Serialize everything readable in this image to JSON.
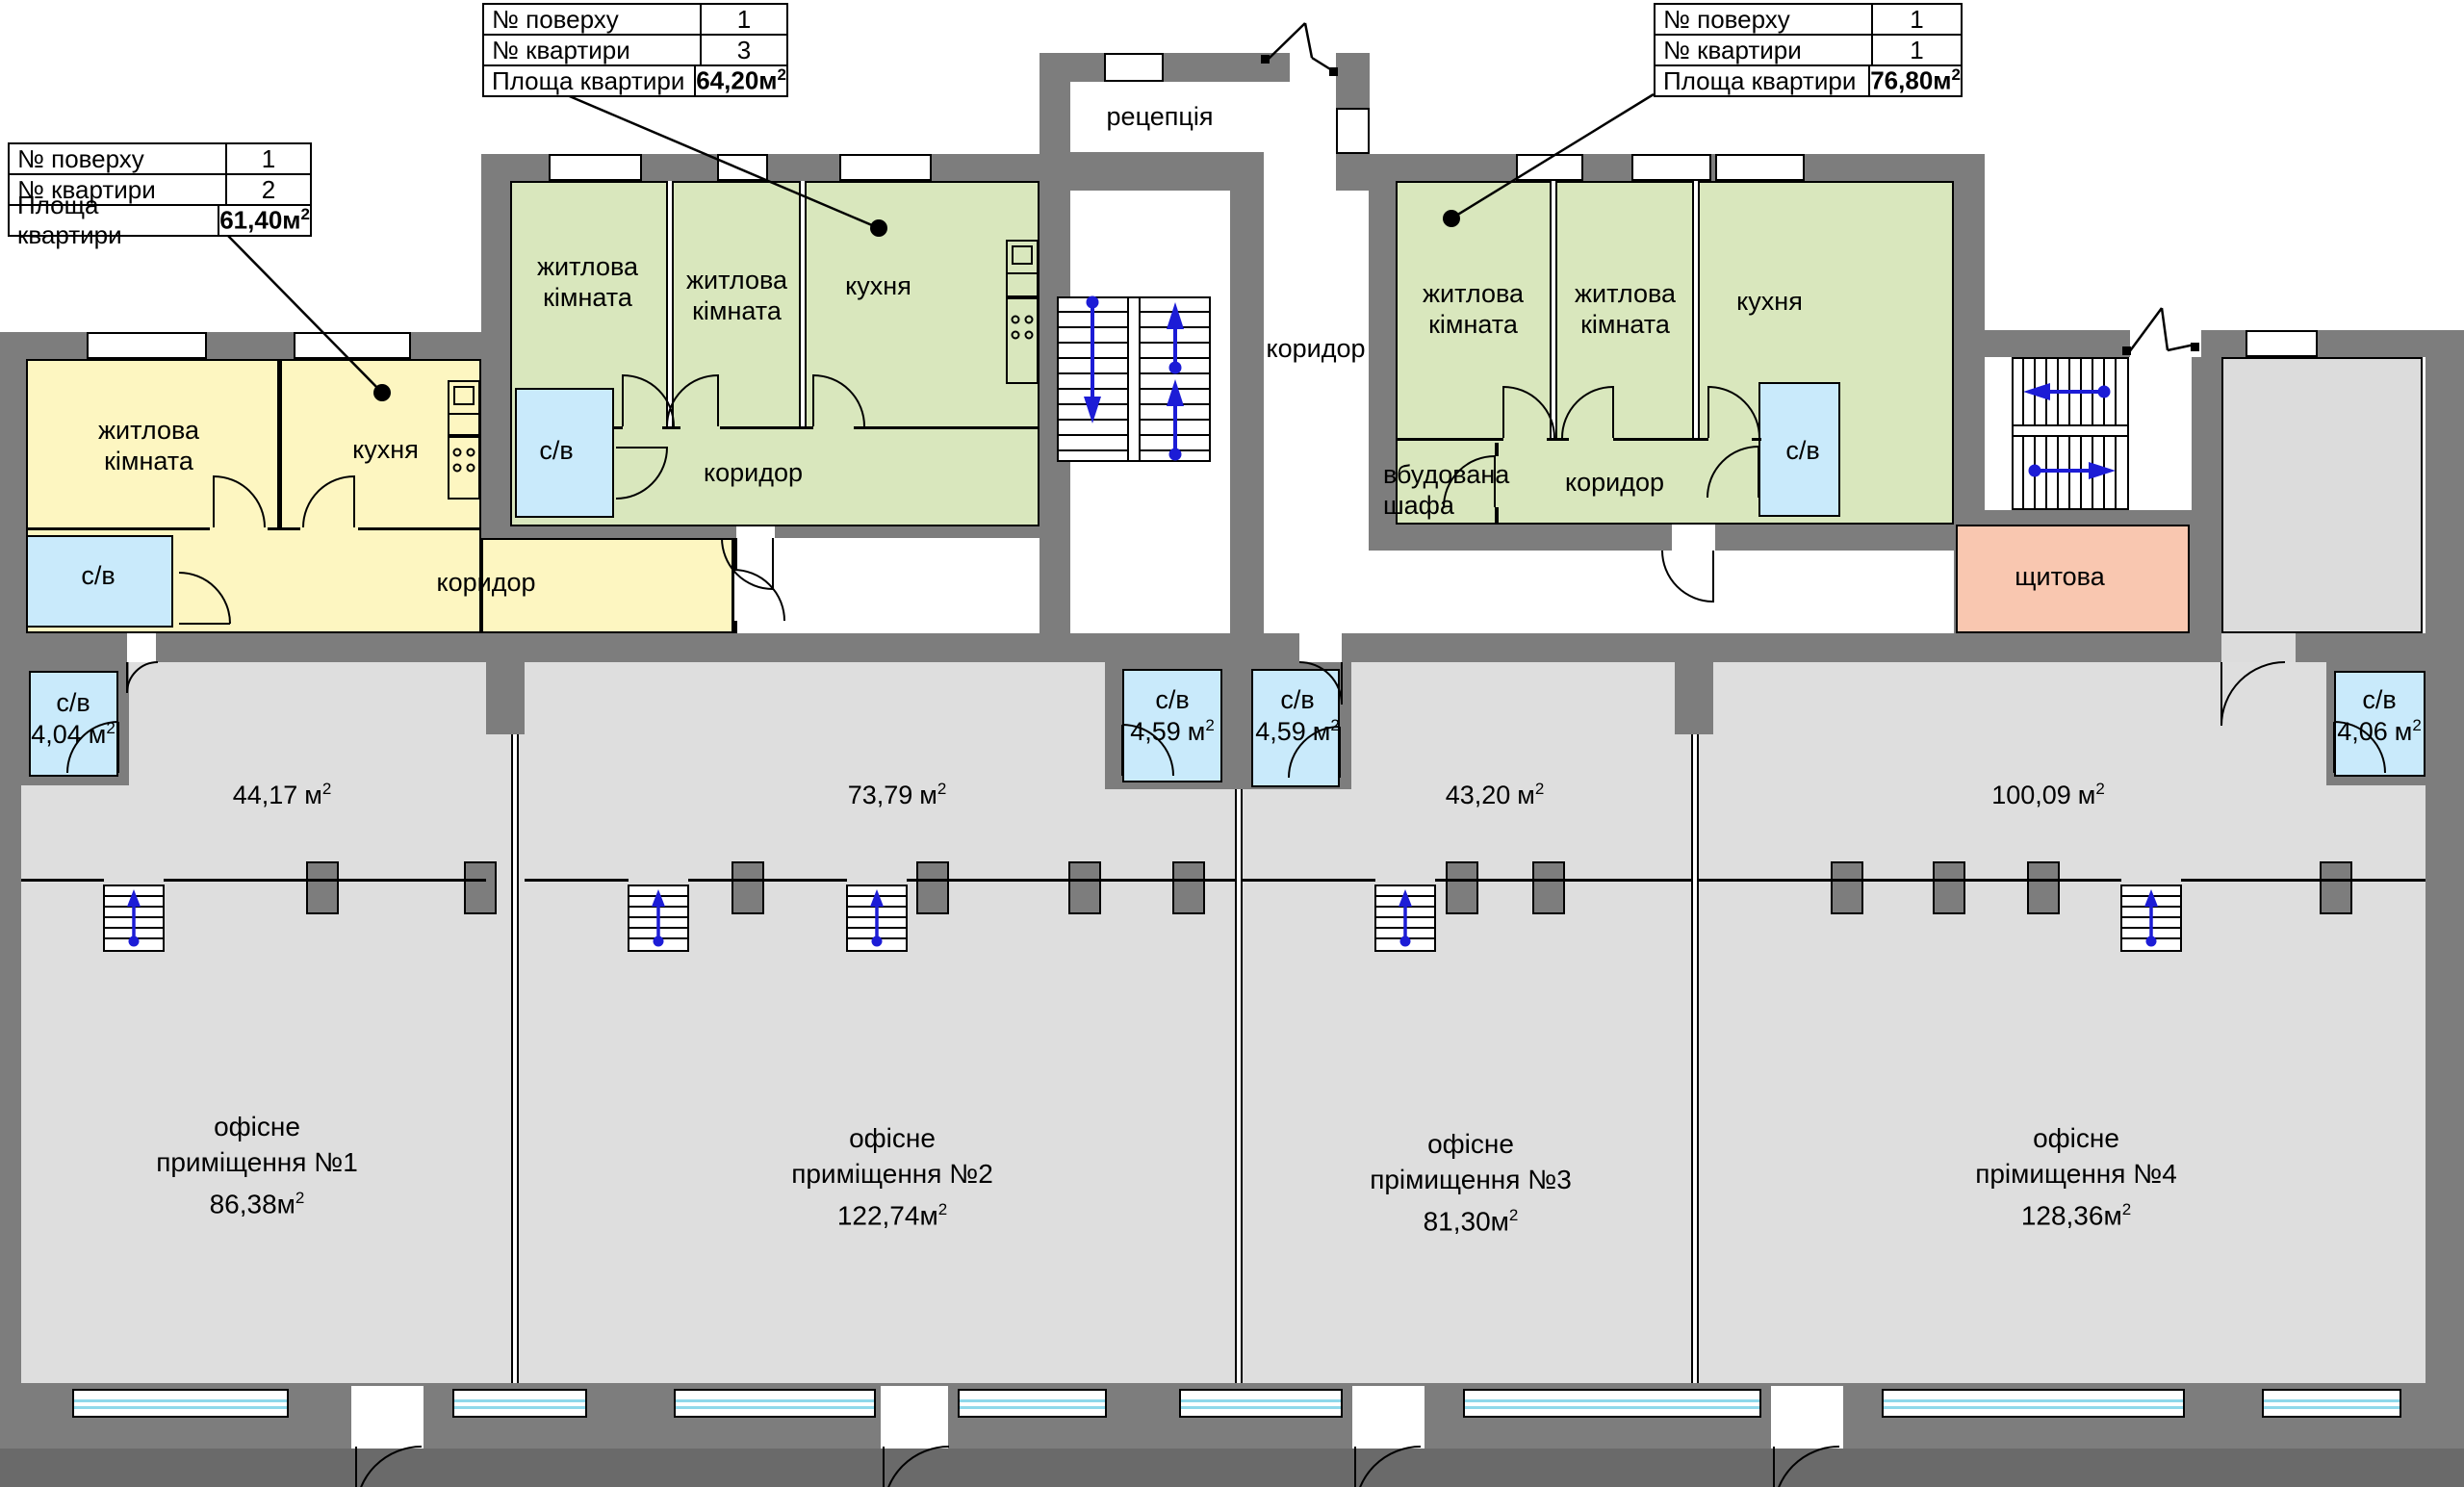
{
  "units": {
    "m": "м",
    "sup": "2"
  },
  "info_tables": [
    {
      "rows": [
        {
          "label": "№ поверху",
          "value": "1"
        },
        {
          "label": "№ квартири",
          "value": "2"
        },
        {
          "label": "Площа квартири",
          "value": "61,40"
        }
      ]
    },
    {
      "rows": [
        {
          "label": "№ поверху",
          "value": "1"
        },
        {
          "label": "№ квартири",
          "value": "3"
        },
        {
          "label": "Площа квартири",
          "value": "64,20"
        }
      ]
    },
    {
      "rows": [
        {
          "label": "№ поверху",
          "value": "1"
        },
        {
          "label": "№ квартири",
          "value": "1"
        },
        {
          "label": "Площа квартири",
          "value": "76,80"
        }
      ]
    }
  ],
  "rooms": {
    "reception": "рецепція",
    "corridor": "коридор",
    "living_room": "житлова кімната",
    "kitchen": "кухня",
    "bathroom": "с/в",
    "wardrobe": "вбудована шафа",
    "panel_room": "щитова"
  },
  "bathroom_areas": {
    "office1": "4,04",
    "office2": "4,59",
    "office3": "4,59",
    "office4": "4,06"
  },
  "open_areas": {
    "office1": "44,17",
    "office2": "73,79",
    "office3": "43,20",
    "office4": "100,09"
  },
  "offices": [
    {
      "line1": "офісне",
      "line2": "приміщення №1",
      "area": "86,38"
    },
    {
      "line1": "офісне",
      "line2": "приміщення №2",
      "area": "122,74"
    },
    {
      "line1": "офісне",
      "line2": "прімищення №3",
      "area": "81,30"
    },
    {
      "line1": "офісне",
      "line2": "прімищення №4",
      "area": "128,36"
    }
  ],
  "colors": {
    "wall": "#7d7d7d",
    "apartment_yellow": "#fdf6c1",
    "apartment_green": "#d9e7bd",
    "bathroom_blue": "#c9eafb",
    "panel_pink": "#f9c7b0",
    "office_gray": "#dedede",
    "stairs_arrow_blue": "#1c1cd6",
    "window_glass": "#8fd8ea"
  }
}
